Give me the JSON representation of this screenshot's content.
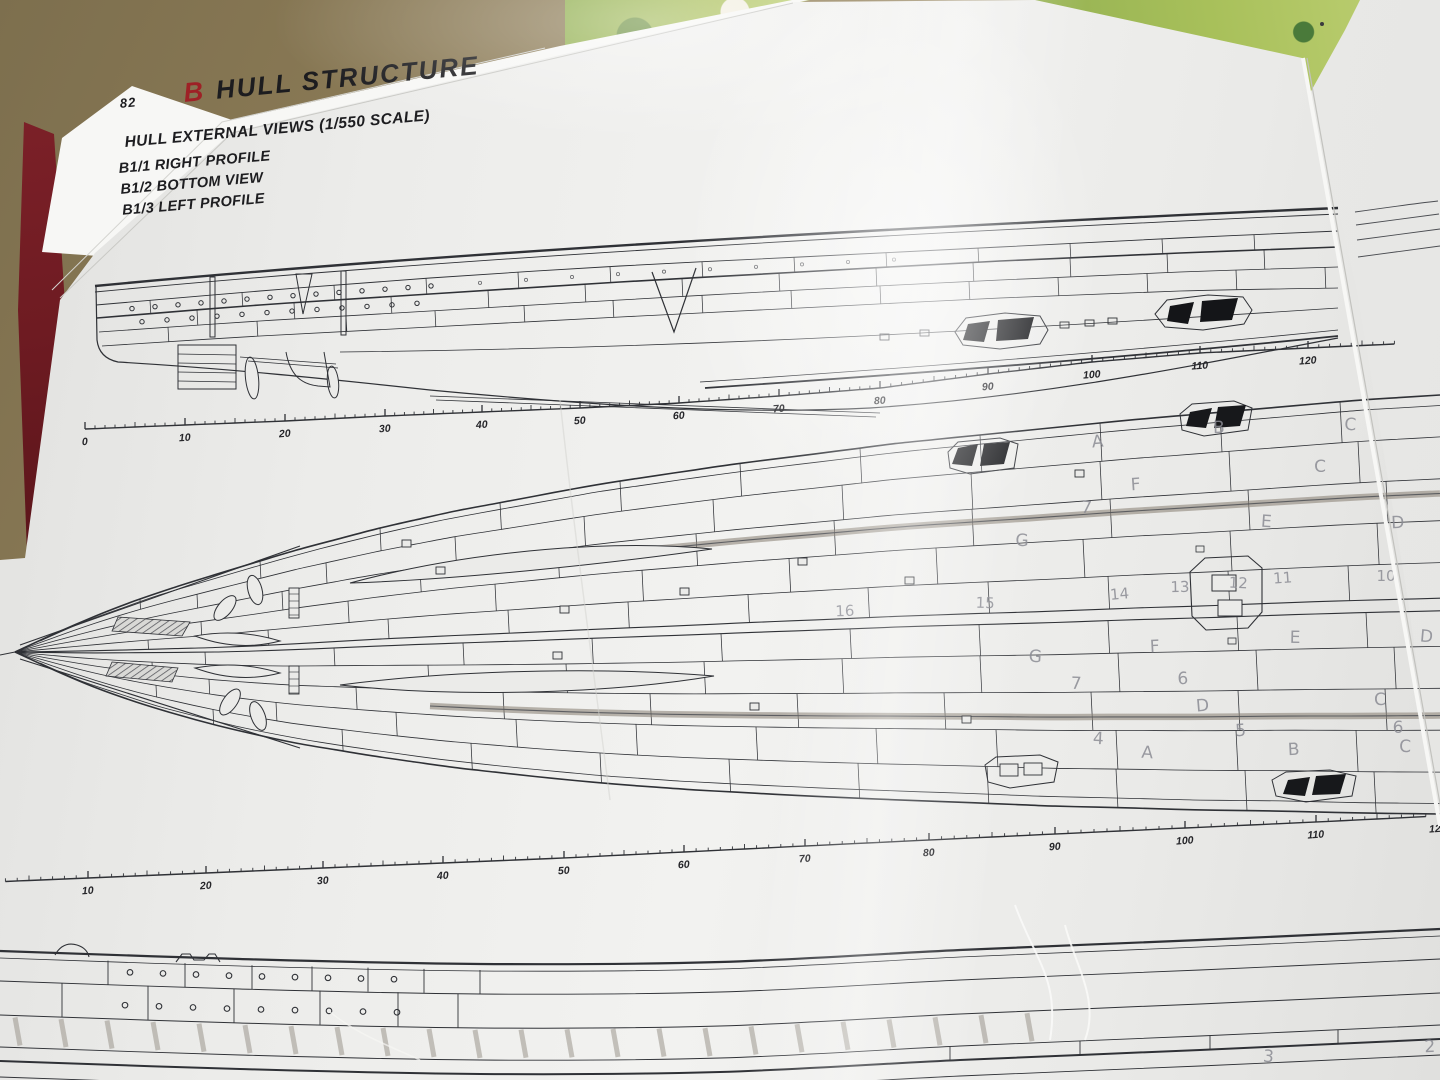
{
  "page": {
    "number": "82",
    "section_letter": "B",
    "section_title": "HULL STRUCTURE",
    "subtitle": "HULL EXTERNAL VIEWS (1/550 SCALE)",
    "view_labels": [
      "B1/1 RIGHT PROFILE",
      "B1/2 BOTTOM VIEW",
      "B1/3 LEFT PROFILE"
    ]
  },
  "rulers": {
    "top": {
      "name": "right-profile-scale",
      "anchors": [
        [
          0,
          85,
          429
        ],
        [
          10,
          185,
          425
        ],
        [
          20,
          285,
          421
        ],
        [
          30,
          385,
          416
        ],
        [
          40,
          482,
          412
        ],
        [
          50,
          580,
          408
        ],
        [
          60,
          679,
          403
        ],
        [
          70,
          779,
          396
        ],
        [
          80,
          880,
          388
        ],
        [
          90,
          988,
          374
        ],
        [
          100,
          1092,
          362
        ],
        [
          110,
          1200,
          353
        ],
        [
          120,
          1308,
          348
        ]
      ],
      "overrun_units": 8
    },
    "middle": {
      "name": "bottom-view-scale",
      "anchors": [
        [
          10,
          88,
          878
        ],
        [
          20,
          206,
          873
        ],
        [
          30,
          323,
          868
        ],
        [
          40,
          443,
          863
        ],
        [
          50,
          564,
          858
        ],
        [
          60,
          684,
          852
        ],
        [
          70,
          805,
          846
        ],
        [
          80,
          929,
          840
        ],
        [
          90,
          1055,
          834
        ],
        [
          100,
          1185,
          828
        ],
        [
          110,
          1316,
          822
        ],
        [
          120,
          1438,
          816
        ]
      ],
      "underrun_units": 7
    }
  },
  "pencil_marks": [
    {
      "t": "A",
      "x": 1098,
      "y": 447
    },
    {
      "t": "B",
      "x": 1219,
      "y": 433
    },
    {
      "t": "C",
      "x": 1350,
      "y": 430
    },
    {
      "t": "F",
      "x": 1136,
      "y": 490
    },
    {
      "t": "C",
      "x": 1320,
      "y": 472
    },
    {
      "t": "E",
      "x": 1266,
      "y": 527
    },
    {
      "t": "D",
      "x": 1398,
      "y": 528
    },
    {
      "t": "G",
      "x": 1022,
      "y": 546
    },
    {
      "t": "7",
      "x": 1086,
      "y": 513
    },
    {
      "t": "16",
      "x": 845,
      "y": 616
    },
    {
      "t": "15",
      "x": 985,
      "y": 608
    },
    {
      "t": "14",
      "x": 1120,
      "y": 599
    },
    {
      "t": "13",
      "x": 1180,
      "y": 592
    },
    {
      "t": "12",
      "x": 1238,
      "y": 588
    },
    {
      "t": "11",
      "x": 1283,
      "y": 583
    },
    {
      "t": "10",
      "x": 1386,
      "y": 581
    },
    {
      "t": "G",
      "x": 1035,
      "y": 662
    },
    {
      "t": "F",
      "x": 1155,
      "y": 652
    },
    {
      "t": "E",
      "x": 1295,
      "y": 643
    },
    {
      "t": "D",
      "x": 1426,
      "y": 642
    },
    {
      "t": "6",
      "x": 1183,
      "y": 684
    },
    {
      "t": "7",
      "x": 1076,
      "y": 689
    },
    {
      "t": "D",
      "x": 1203,
      "y": 711
    },
    {
      "t": "C",
      "x": 1380,
      "y": 705
    },
    {
      "t": "4",
      "x": 1098,
      "y": 744
    },
    {
      "t": "5",
      "x": 1241,
      "y": 736
    },
    {
      "t": "6",
      "x": 1398,
      "y": 733
    },
    {
      "t": "A",
      "x": 1147,
      "y": 758
    },
    {
      "t": "B",
      "x": 1294,
      "y": 755
    },
    {
      "t": "C",
      "x": 1405,
      "y": 752
    },
    {
      "t": "3",
      "x": 1268,
      "y": 1062
    },
    {
      "t": "2",
      "x": 1430,
      "y": 1052
    }
  ],
  "colors": {
    "accent": "#9e2126",
    "paper": "#ededeb",
    "ink": "#2f3136",
    "pencil": "#8b8c94",
    "cover": "#78202a",
    "floor": "#91805b",
    "fabric": "#a2b95c"
  }
}
